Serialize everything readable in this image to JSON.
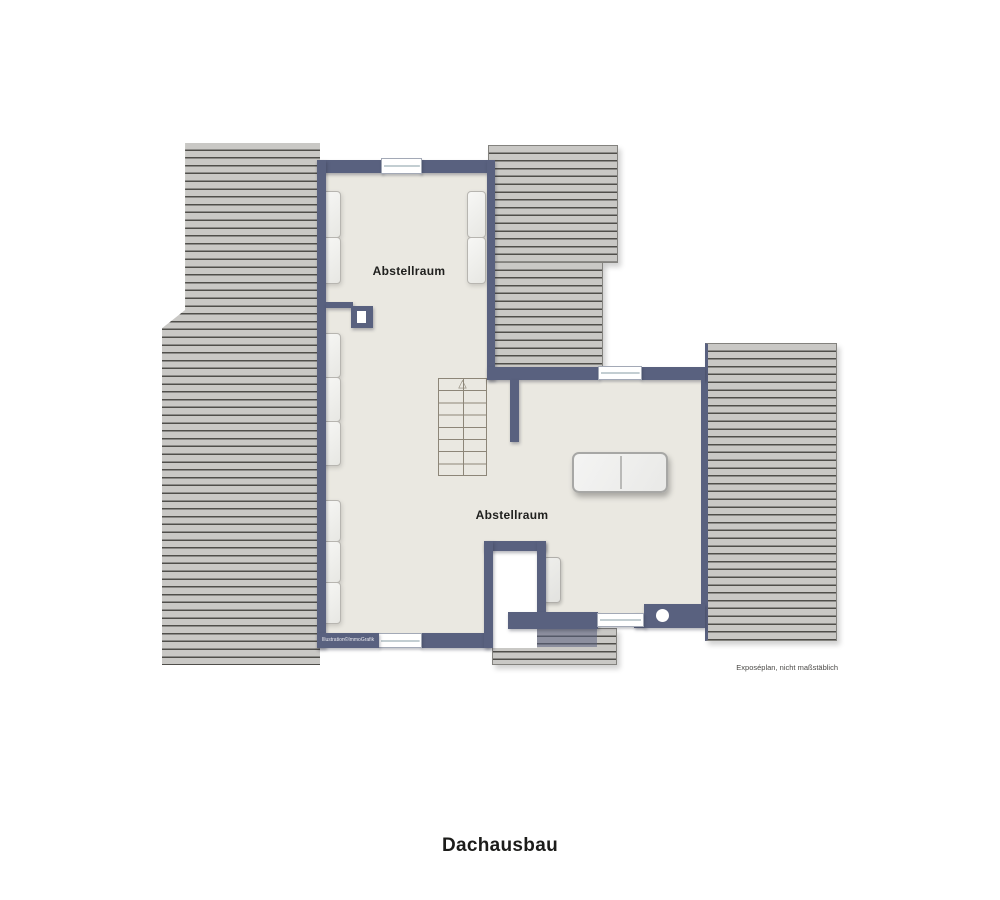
{
  "plan": {
    "title": "Dachausbau",
    "rooms": [
      {
        "label": "Abstellraum"
      },
      {
        "label": "Abstellraum"
      }
    ],
    "watermark": "Illustration©ImmoGrafik",
    "disclaimer": "Exposéplan, nicht maßstäblich",
    "icons": {
      "stairs_up_arrow": "△"
    },
    "colors": {
      "wall": "#59617f",
      "hatch_fill": "#c9c8c5",
      "hatch_line": "#4f4e4a",
      "floor": "#eae8e1",
      "background": "#ffffff"
    }
  }
}
